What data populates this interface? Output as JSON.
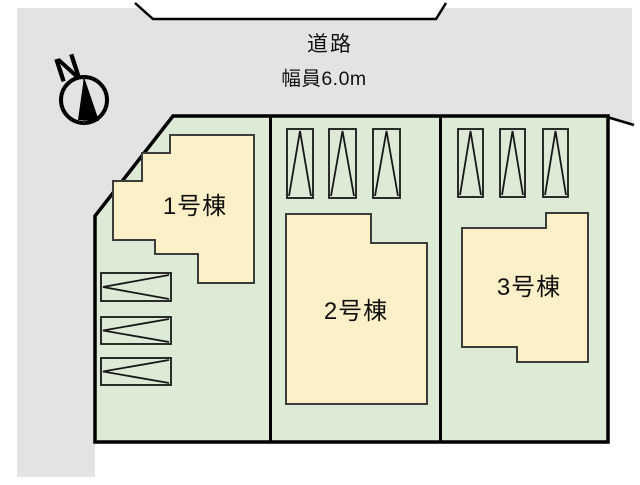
{
  "title": "区画図",
  "road": {
    "label": "道路",
    "width_label": "幅員6.0m"
  },
  "compass": {
    "label": "N"
  },
  "buildings": [
    {
      "id": 1,
      "label": "1号棟"
    },
    {
      "id": 2,
      "label": "2号棟"
    },
    {
      "id": 3,
      "label": "3号棟"
    }
  ],
  "parking": {
    "plot1_spaces": 3,
    "plot2_spaces": 3,
    "plot3_spaces": 3,
    "marker": "parking-space-arrow"
  },
  "colors": {
    "road": "#e3e3e3",
    "plot": "#dcead6",
    "building": "#fcf0c8",
    "line": "#000000"
  }
}
